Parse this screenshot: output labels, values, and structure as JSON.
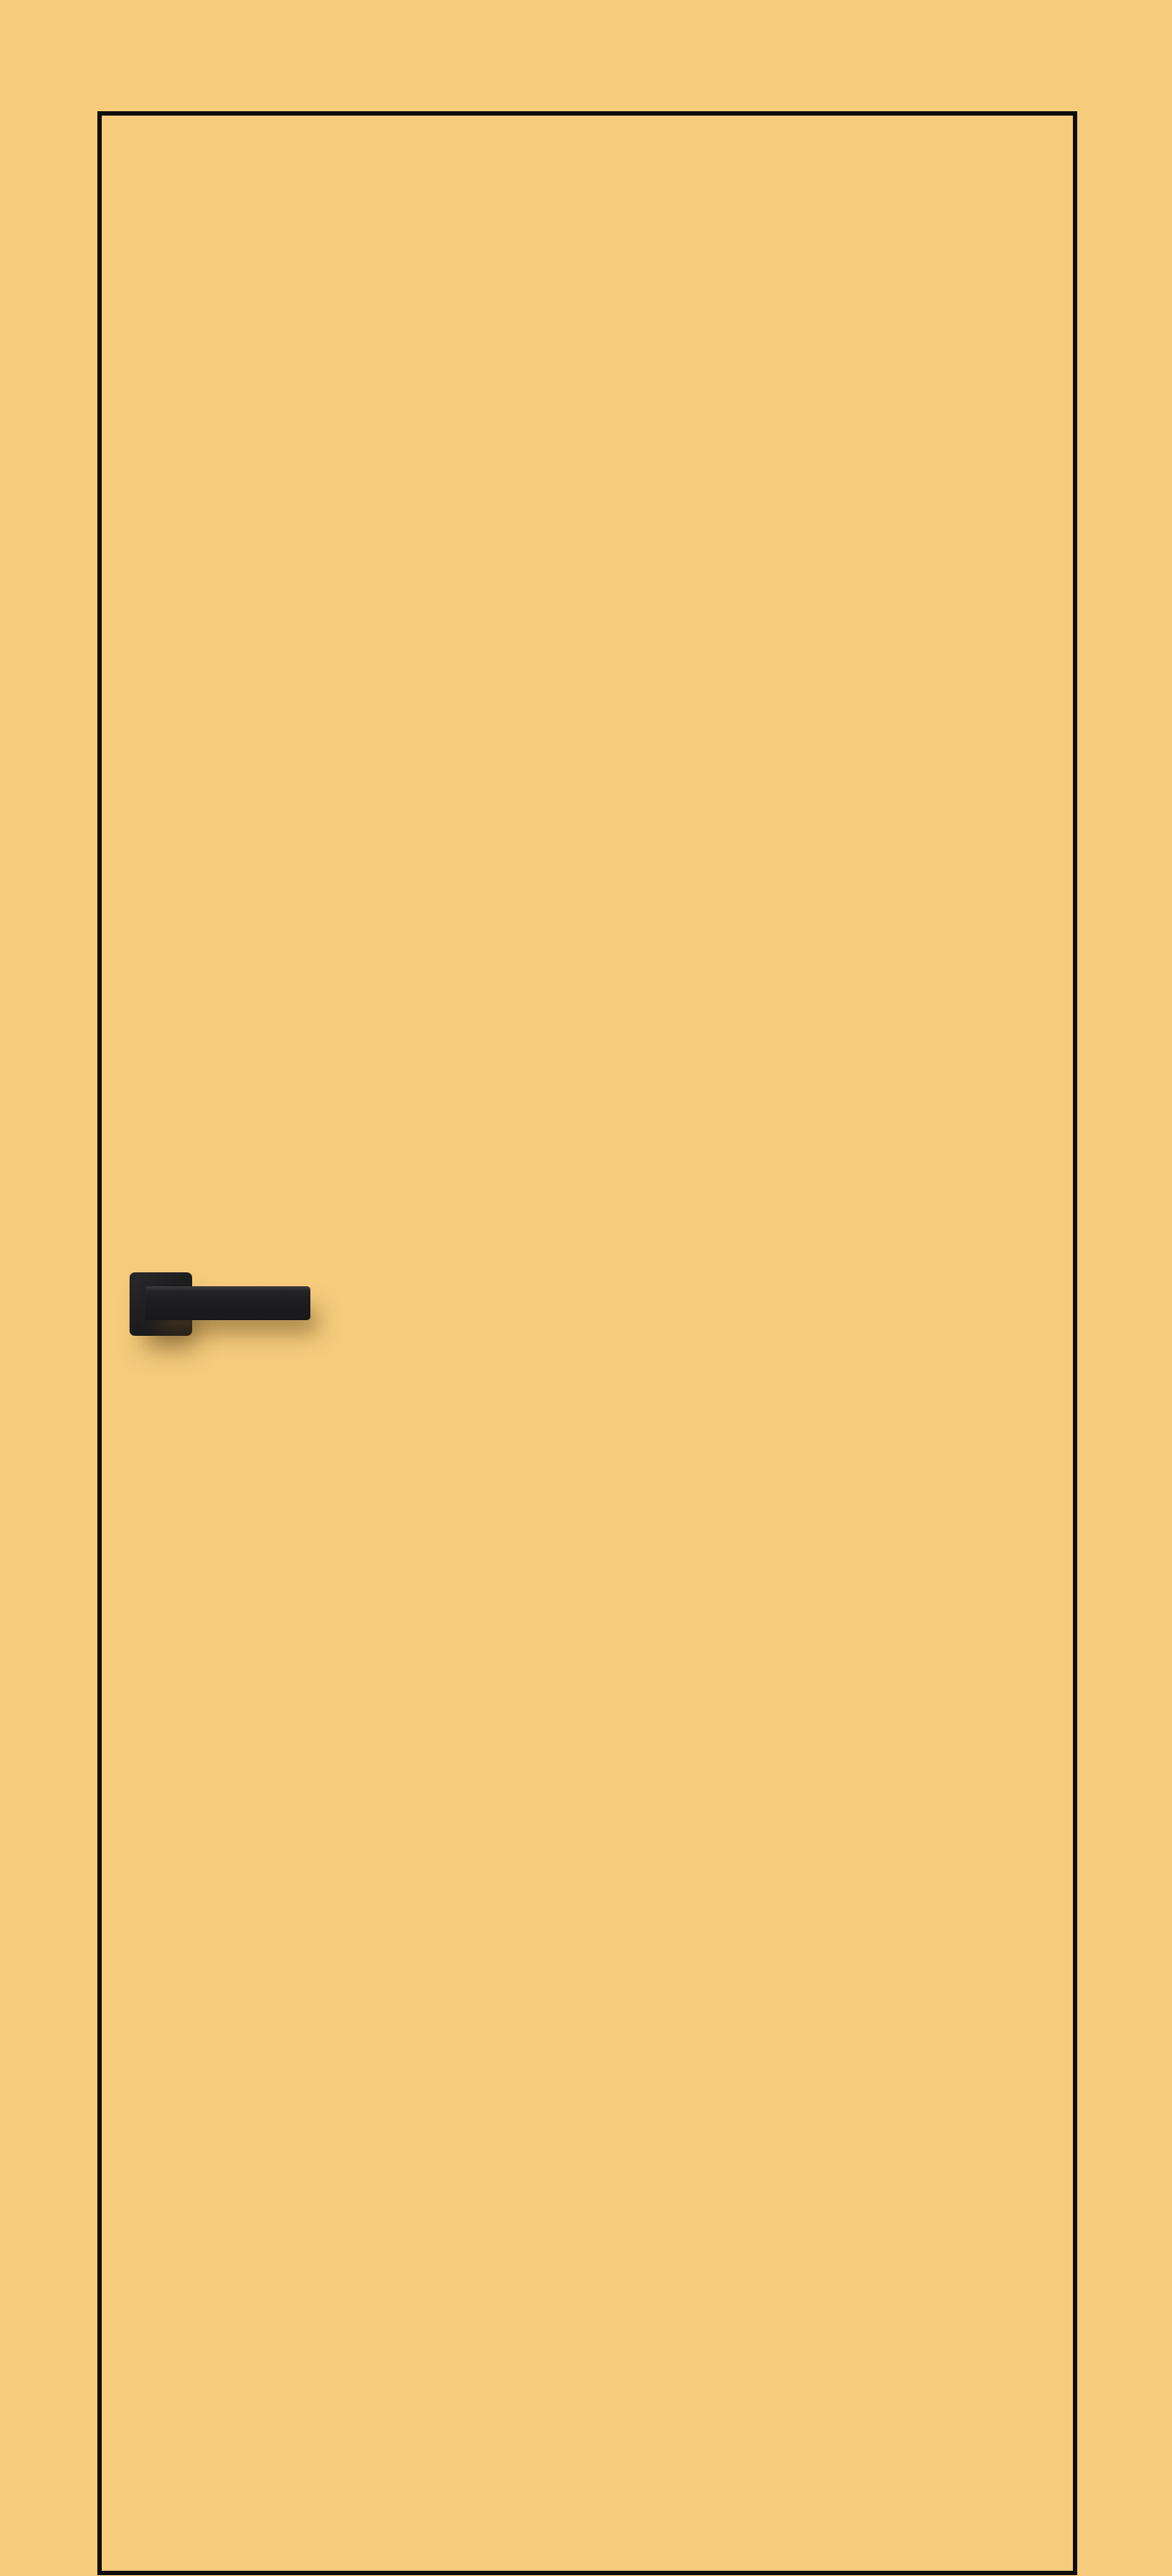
{
  "scene": {
    "description": "Frameless flush interior door leaf finished in the same mustard-yellow color as the surrounding wall, delineated by a thin black edge line, fitted with a matte black square-rosette lever handle casting a soft shadow",
    "background_color": "#f6cb7c",
    "door": {
      "finish_color": "#f6cb7c",
      "outline_color": "#0f0d08",
      "outline_thickness_px": 5
    },
    "handle": {
      "type": "square-rosette-lever",
      "body_color": "#1e1e20",
      "highlight_color": "#3c3c3e",
      "shadow_color": "rgba(100,74,32,0.50)",
      "orientation": "lever-pointing-right"
    }
  }
}
